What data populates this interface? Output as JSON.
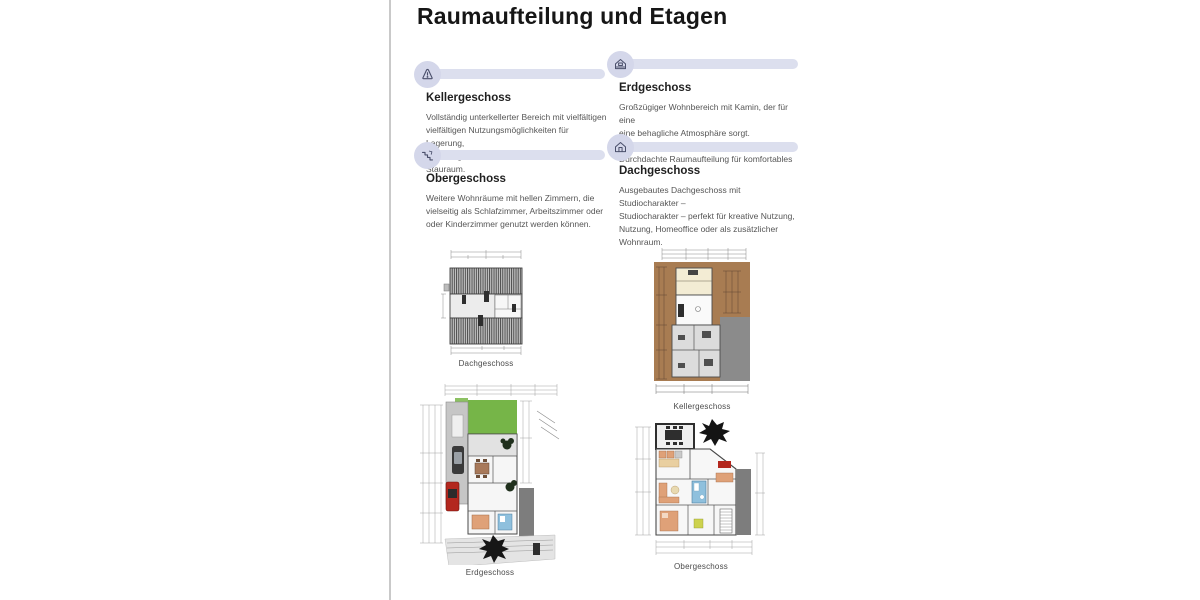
{
  "page": {
    "title": "Raumaufteilung und Etagen"
  },
  "sections": [
    {
      "id": "kellergeschoss",
      "title": "Kellergeschoss",
      "icon": "alert-triangle-icon",
      "body": "Vollständig unterkellerter Bereich mit vielfältigen\nvielfältigen Nutzungsmöglichkeiten für Lagerung,\nLagerung, Haustechnik und zusätzlichen Stauraum."
    },
    {
      "id": "obergeschoss",
      "title": "Obergeschoss",
      "icon": "stairs-icon",
      "body": "Weitere Wohnräume mit hellen Zimmern, die\nvielseitig als Schlafzimmer, Arbeitszimmer oder\noder Kinderzimmer genutzt werden können."
    },
    {
      "id": "erdgeschoss",
      "title": "Erdgeschoss",
      "icon": "house-icon",
      "body": "Großzügiger Wohnbereich mit Kamin, der für eine\neine behagliche Atmosphäre sorgt. Durchdachte\nDurchdachte Raumaufteilung für komfortables"
    },
    {
      "id": "dachgeschoss",
      "title": "Dachgeschoss",
      "icon": "house-door-icon",
      "body": "Ausgebautes Dachgeschoss mit Studiocharakter –\nStudiocharakter – perfekt für kreative Nutzung,\nNutzung, Homeoffice oder als zusätzlicher\nWohnraum."
    }
  ],
  "floorplans": [
    {
      "id": "dachgeschoss-plan",
      "label": "Dachgeschoss"
    },
    {
      "id": "erdgeschoss-plan",
      "label": "Erdgeschoss"
    },
    {
      "id": "kellergeschoss-plan",
      "label": "Kellergeschoss"
    },
    {
      "id": "obergeschoss-plan",
      "label": "Obergeschoss"
    }
  ],
  "colors": {
    "accent_bar": "#dcdfee",
    "icon_circle": "#d4d7ea",
    "icon_glyph": "#4a4f6b",
    "garden_green": "#76b548",
    "earth_brown": "#a87c52",
    "band_gray": "#7d7d7d",
    "furniture_salmon": "#dfa178",
    "bath_blue": "#8fc0dd",
    "accent_red": "#b3271e"
  }
}
